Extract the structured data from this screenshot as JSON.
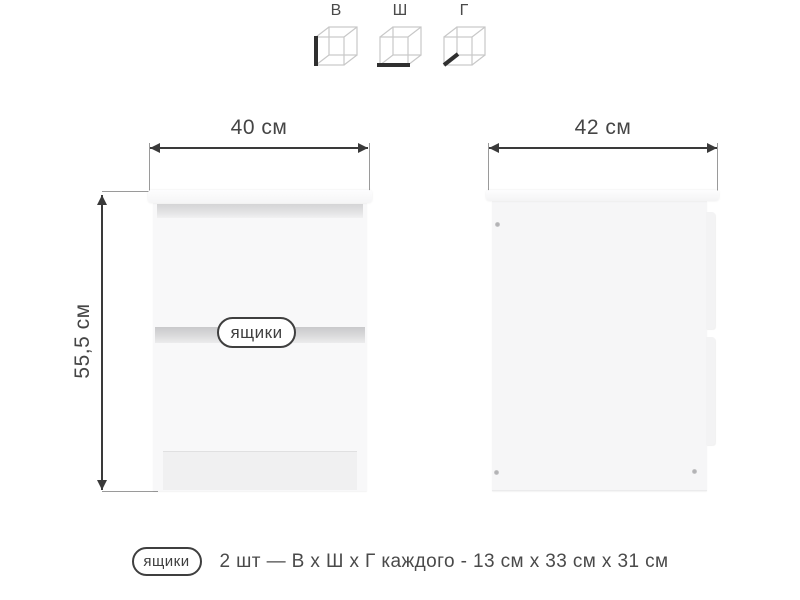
{
  "dimension_cubes": {
    "items": [
      {
        "label": "В",
        "meaning": "height"
      },
      {
        "label": "Ш",
        "meaning": "width"
      },
      {
        "label": "Г",
        "meaning": "depth"
      }
    ]
  },
  "front_view": {
    "width_dim": "40 см",
    "height_dim": "55,5 см",
    "drawers_tag": "ящики"
  },
  "side_view": {
    "depth_dim": "42 см"
  },
  "footnote": {
    "tag": "ящики",
    "text": "2 шт — В х Ш х Г каждого - 13 см х 33 см х 31 см"
  },
  "colors": {
    "background": "#ffffff",
    "text": "#4a4a4a",
    "dimension_line": "#3a3a3a",
    "cube_wireframe": "#c8c8c8",
    "cube_highlight": "#2f2f2f",
    "furniture_body": "#f8f8f9",
    "shadow_band": "#c9c9cb"
  }
}
